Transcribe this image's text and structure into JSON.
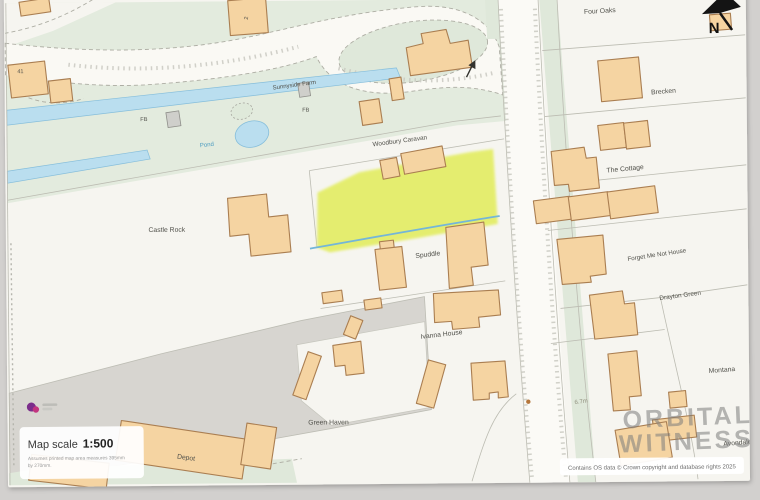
{
  "map": {
    "labels": {
      "four_oaks": "Four Oaks",
      "brecken": "Brecken",
      "the_cottage": "The Cottage",
      "forget_me_not": "Forget Me Not House",
      "drayton_green": "Drayton Green",
      "montana": "Montana",
      "avondale": "Avondale",
      "sunnyside_farm": "Sunnyside Farm",
      "woodbury_caravan": "Woodbury Caravan",
      "castle_rock": "Castle Rock",
      "spuddle": "Spuddle",
      "ivanna_house": "Ivanna House",
      "green_haven": "Green Haven",
      "depot": "Depot",
      "pond": "Pond",
      "fb": "FB",
      "plot_41": "41",
      "plot_2": "2",
      "spot_height": "6.7m",
      "north": "N"
    },
    "colors": {
      "sheet": "#f6f5f0",
      "greenspace": "#e3ebde",
      "building": "#f5d4a2",
      "building_outline": "#aa7e51",
      "water": "#badeef",
      "highlight_parcel": "#e3ed62",
      "yard_gray": "#d7d5d0"
    }
  },
  "overlay": {
    "scale_label": "Map scale",
    "scale_value": "1:500",
    "scale_note_line1": "Assumes printed map area measures 395mm",
    "scale_note_line2": "by 270mm.",
    "copyright": "Contains OS data © Crown copyright and database rights 2025"
  },
  "watermark": {
    "line1": "ORBITAL",
    "line2": "WITNESS"
  }
}
